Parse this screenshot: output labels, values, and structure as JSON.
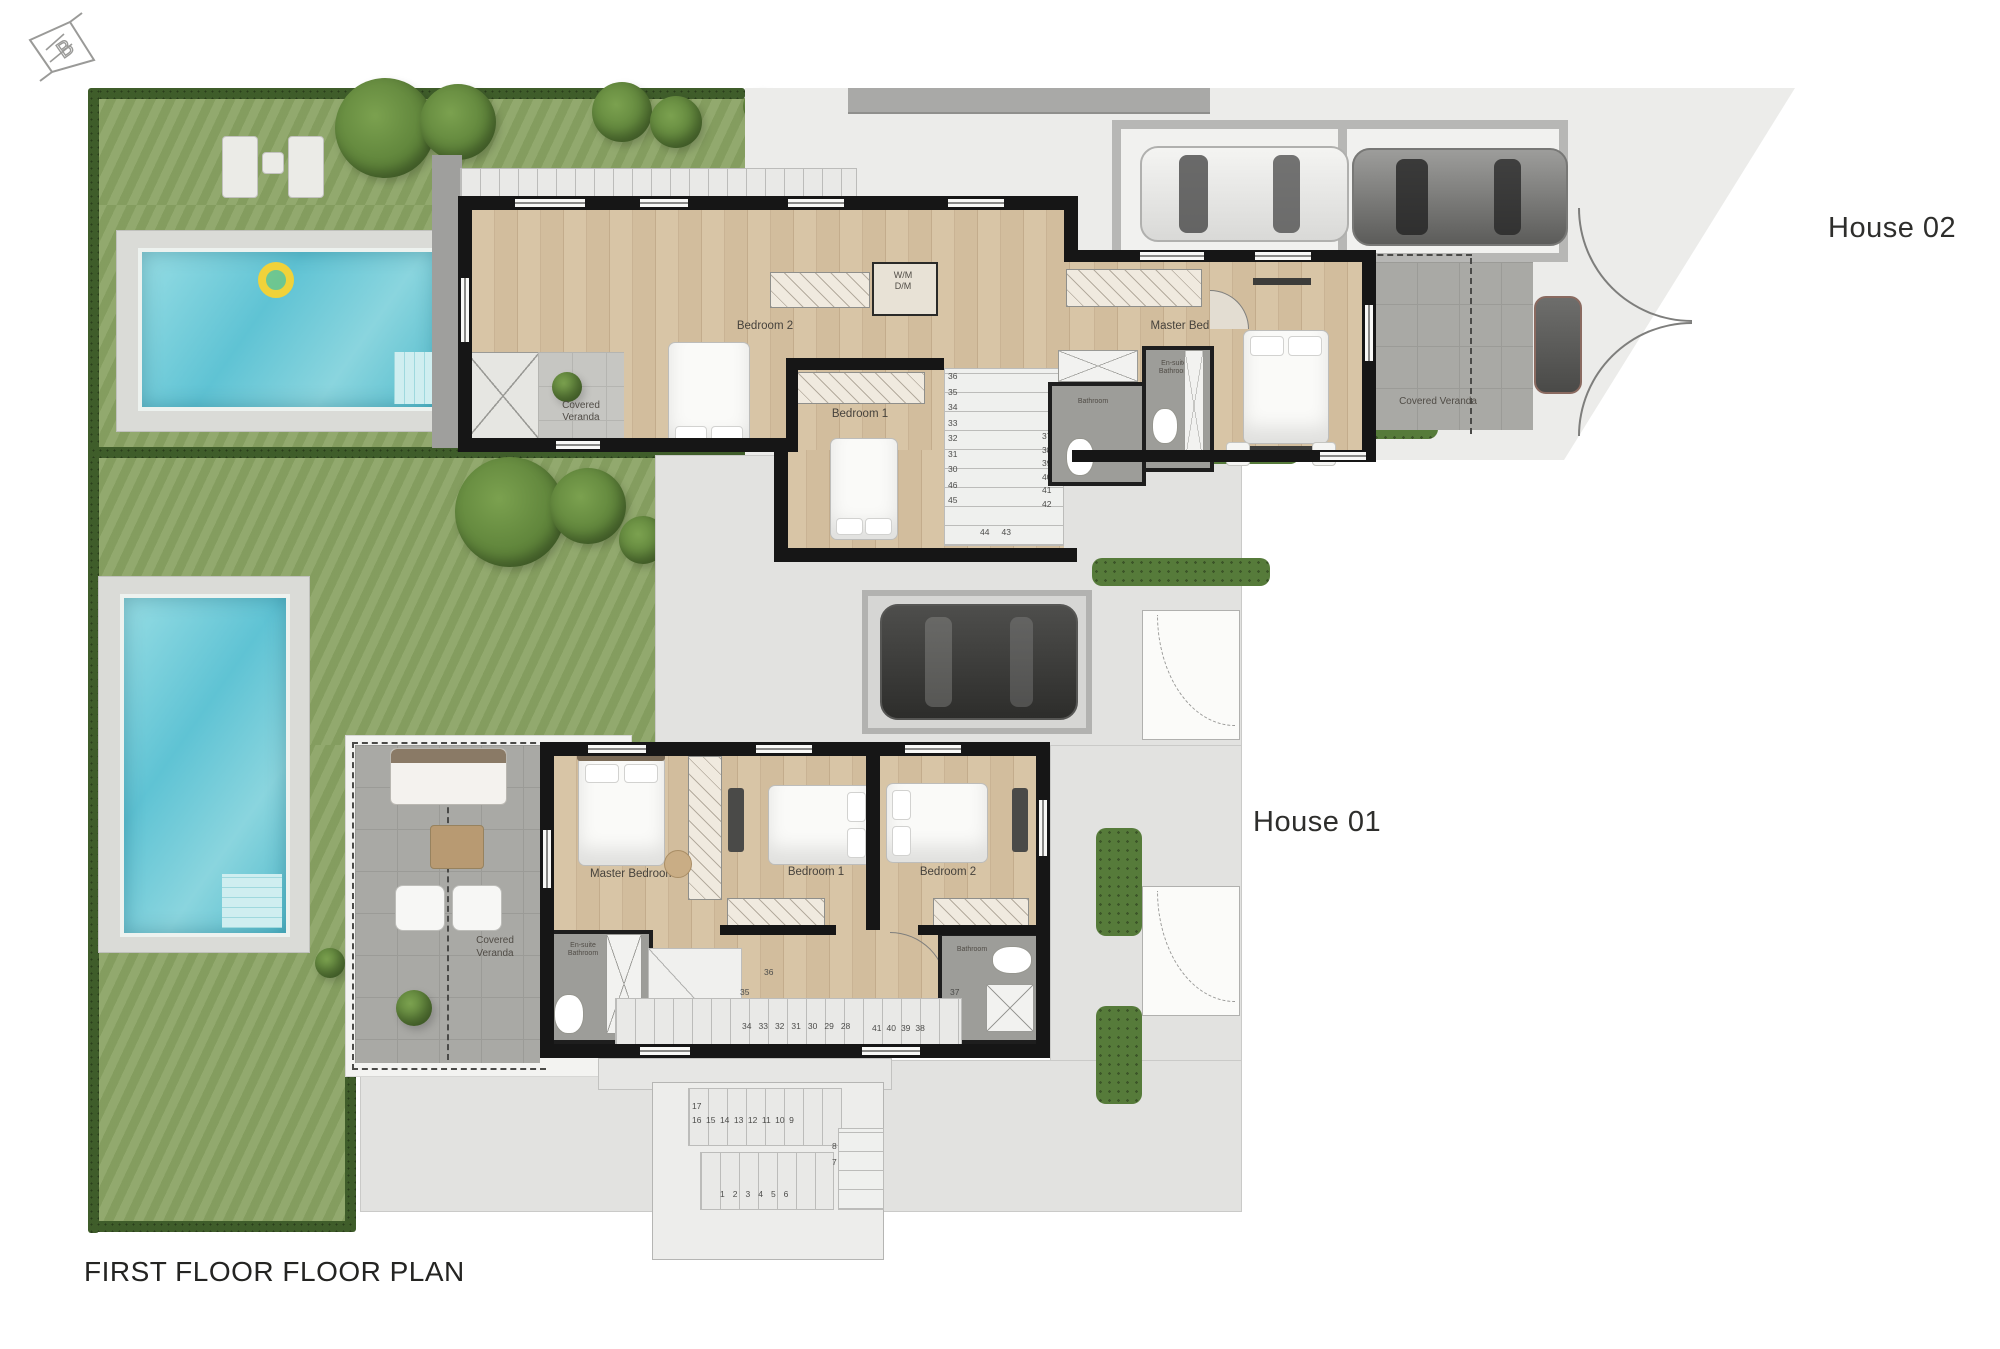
{
  "title": "FIRST FLOOR FLOOR PLAN",
  "logo_letter": "B",
  "house02": {
    "label": "House 02",
    "bedroom2": "Bedroom 2",
    "bedroom1": "Bedroom 1",
    "master": "Master Bedroom",
    "veranda": "Covered Veranda",
    "veranda_left_line1": "Covered",
    "veranda_left_line2": "Veranda",
    "wm": "W/M",
    "dm": "D/M",
    "bathroom": "Bathroom",
    "ensuite_line1": "En-suite",
    "ensuite_line2": "Bathroom",
    "entry_steps": [
      "1",
      "2",
      "3",
      "4"
    ],
    "stairs_left": [
      "36",
      "35",
      "34",
      "33",
      "32",
      "31",
      "30",
      "46",
      "45"
    ],
    "stairs_right": [
      "37",
      "38",
      "39",
      "40",
      "41",
      "42"
    ],
    "stairs_bottom": [
      "44",
      "43"
    ]
  },
  "house01": {
    "label": "House 01",
    "master": "Master Bedroom",
    "bedroom1": "Bedroom 1",
    "bedroom2": "Bedroom 2",
    "veranda_line1": "Covered",
    "veranda_line2": "Veranda",
    "bathroom": "Bathroom",
    "ensuite_line1": "En-suite",
    "ensuite_line2": "Bathroom",
    "stairs_row1": [
      "34",
      "33",
      "32",
      "31",
      "30",
      "29",
      "28"
    ],
    "stairs_row2": [
      "41",
      "40",
      "39",
      "38"
    ],
    "stair_36": "36",
    "stair_35": "35",
    "stair_37": "37"
  },
  "exterior_stairs": {
    "top": "17",
    "row": [
      "16",
      "15",
      "14",
      "13",
      "12",
      "11",
      "10",
      "9"
    ],
    "side": [
      "8",
      "7"
    ],
    "bottom": [
      "1",
      "2",
      "3",
      "4",
      "5",
      "6"
    ]
  }
}
